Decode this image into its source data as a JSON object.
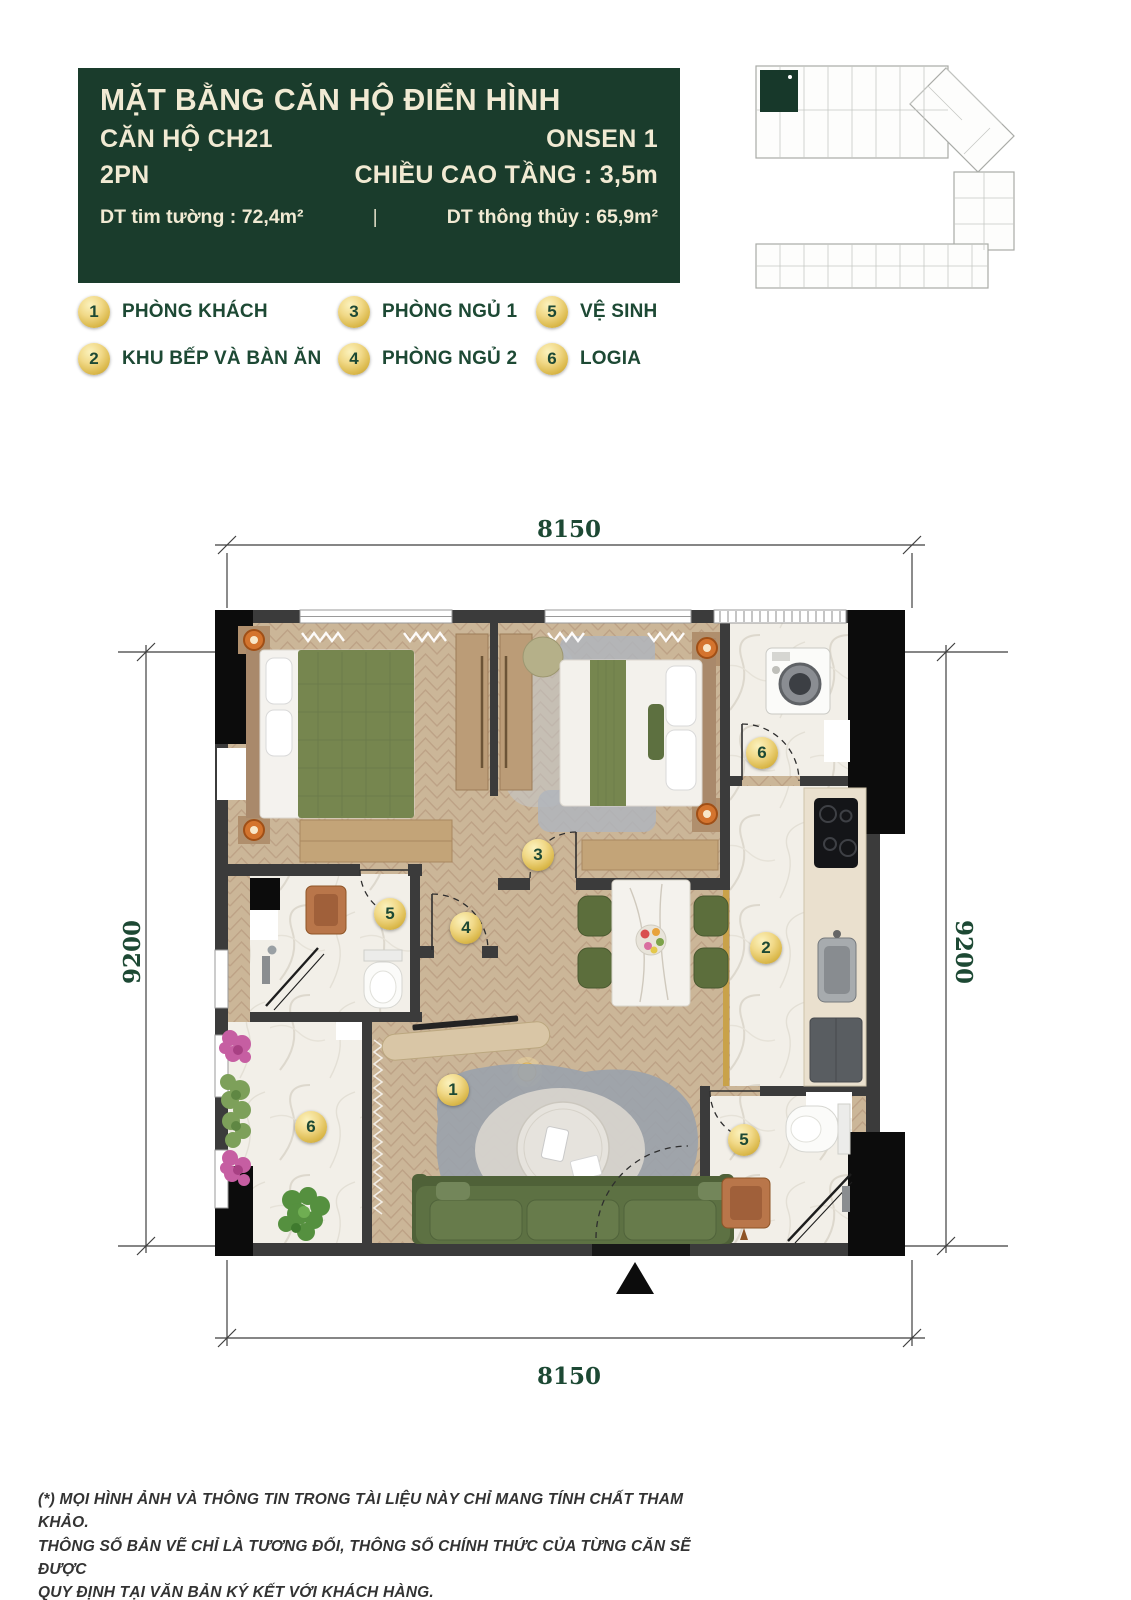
{
  "header": {
    "title": "MẶT BẰNG CĂN HỘ ĐIỂN HÌNH",
    "unit": "CĂN HỘ CH21",
    "project": "ONSEN 1",
    "bedrooms": "2PN",
    "floor_height": "CHIỀU CAO TẦNG : 3,5m",
    "area_wall": "DT tim tường : 72,4m²",
    "separator": "|",
    "area_clear": "DT thông thủy : 65,9m²",
    "bg_color": "#1a3c2c",
    "text_color": "#f1ead3"
  },
  "legend": {
    "items": [
      {
        "num": "1",
        "label": "PHÒNG KHÁCH"
      },
      {
        "num": "2",
        "label": "KHU BẾP VÀ BÀN ĂN"
      },
      {
        "num": "3",
        "label": "PHÒNG NGỦ 1"
      },
      {
        "num": "4",
        "label": "PHÒNG NGỦ 2"
      },
      {
        "num": "5",
        "label": "VỆ SINH"
      },
      {
        "num": "6",
        "label": "LOGIA"
      }
    ]
  },
  "plan": {
    "dimensions": {
      "top": "8150",
      "bottom": "8150",
      "left": "9200",
      "right": "9200"
    },
    "badges": {
      "living_room": "1",
      "kitchen": "2",
      "bedroom_1": "3",
      "bedroom_2": "4",
      "bathroom_1": "5",
      "bathroom_2": "5",
      "logia_top": "6",
      "logia_bottom": "6"
    },
    "badge_color": "#dab84a",
    "dimension_text_color": "#1d4934"
  },
  "minimap": {
    "highlight_color": "#17382a"
  },
  "footer": {
    "disclaimer": "(*) MỌI HÌNH ẢNH VÀ THÔNG TIN TRONG TÀI LIỆU NÀY CHỈ MANG TÍNH  CHẤT THAM KHẢO.\nTHÔNG SỐ BẢN VẼ CHỈ LÀ TƯƠNG ĐỐI, THÔNG SỐ CHÍNH THỨC CỦA TỪNG CĂN SẼ ĐƯỢC\nQUY ĐỊNH TẠI VĂN BẢN KÝ KẾT VỚI KHÁCH HÀNG."
  }
}
